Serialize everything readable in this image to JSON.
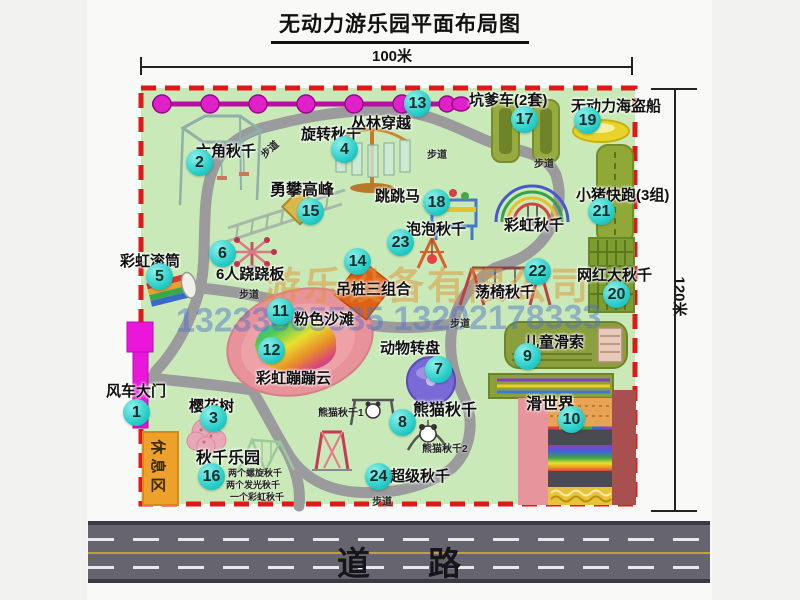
{
  "title": "无动力游乐园平面布局图",
  "dimensions": {
    "width": "100米",
    "height": "120米"
  },
  "road_label": "道路",
  "rest_area_label": "休息区",
  "path_label": "步道",
  "watermark": {
    "company": "游乐设备有限公司",
    "phone": "13233805535 13202178333"
  },
  "attractions": [
    {
      "num": "1",
      "name": "风车大门"
    },
    {
      "num": "2",
      "name": "六角秋千"
    },
    {
      "num": "3",
      "name": "樱花树"
    },
    {
      "num": "4",
      "name": "旋转秋千"
    },
    {
      "num": "5",
      "name": "彩虹滚筒"
    },
    {
      "num": "6",
      "name": "6人跷跷板"
    },
    {
      "num": "7",
      "name": "动物转盘"
    },
    {
      "num": "8",
      "name": "熊猫秋千"
    },
    {
      "num": "9",
      "name": "儿童滑索"
    },
    {
      "num": "10",
      "name": "滑世界"
    },
    {
      "num": "11",
      "name": "粉色沙滩"
    },
    {
      "num": "12",
      "name": "彩虹蹦蹦云"
    },
    {
      "num": "13",
      "name": "丛林穿越"
    },
    {
      "num": "14",
      "name": "吊桩三组合"
    },
    {
      "num": "15",
      "name": "勇攀高峰"
    },
    {
      "num": "16",
      "name": "秋千乐园"
    },
    {
      "num": "17",
      "name": "坑爹车(2套)"
    },
    {
      "num": "18",
      "name": "跳跳马"
    },
    {
      "num": "19",
      "name": "无动力海盗船"
    },
    {
      "num": "20",
      "name": "网红大秋千"
    },
    {
      "num": "21",
      "name": "小猪快跑(3组)"
    },
    {
      "num": "22",
      "name": "荡椅秋千"
    },
    {
      "num": "23",
      "name": "泡泡秋千"
    },
    {
      "num": "24",
      "name": "超级秋千"
    }
  ],
  "annotations": {
    "rainbow_swing": "彩虹秋千",
    "panda_swing_1": "熊猫秋千1",
    "panda_swing_2": "熊猫秋千2",
    "swing_park_items": [
      "两个螺旋秋千",
      "两个发光秋千",
      "一个彩虹秋千"
    ]
  },
  "colors": {
    "badge_cyan": "#27cdc9",
    "map_green": "#c9eab8",
    "border_red": "#e01818",
    "banner_magenta": "#e01ec8",
    "gate_magenta": "#ea16da",
    "rest_area_orange": "#eda02a"
  }
}
